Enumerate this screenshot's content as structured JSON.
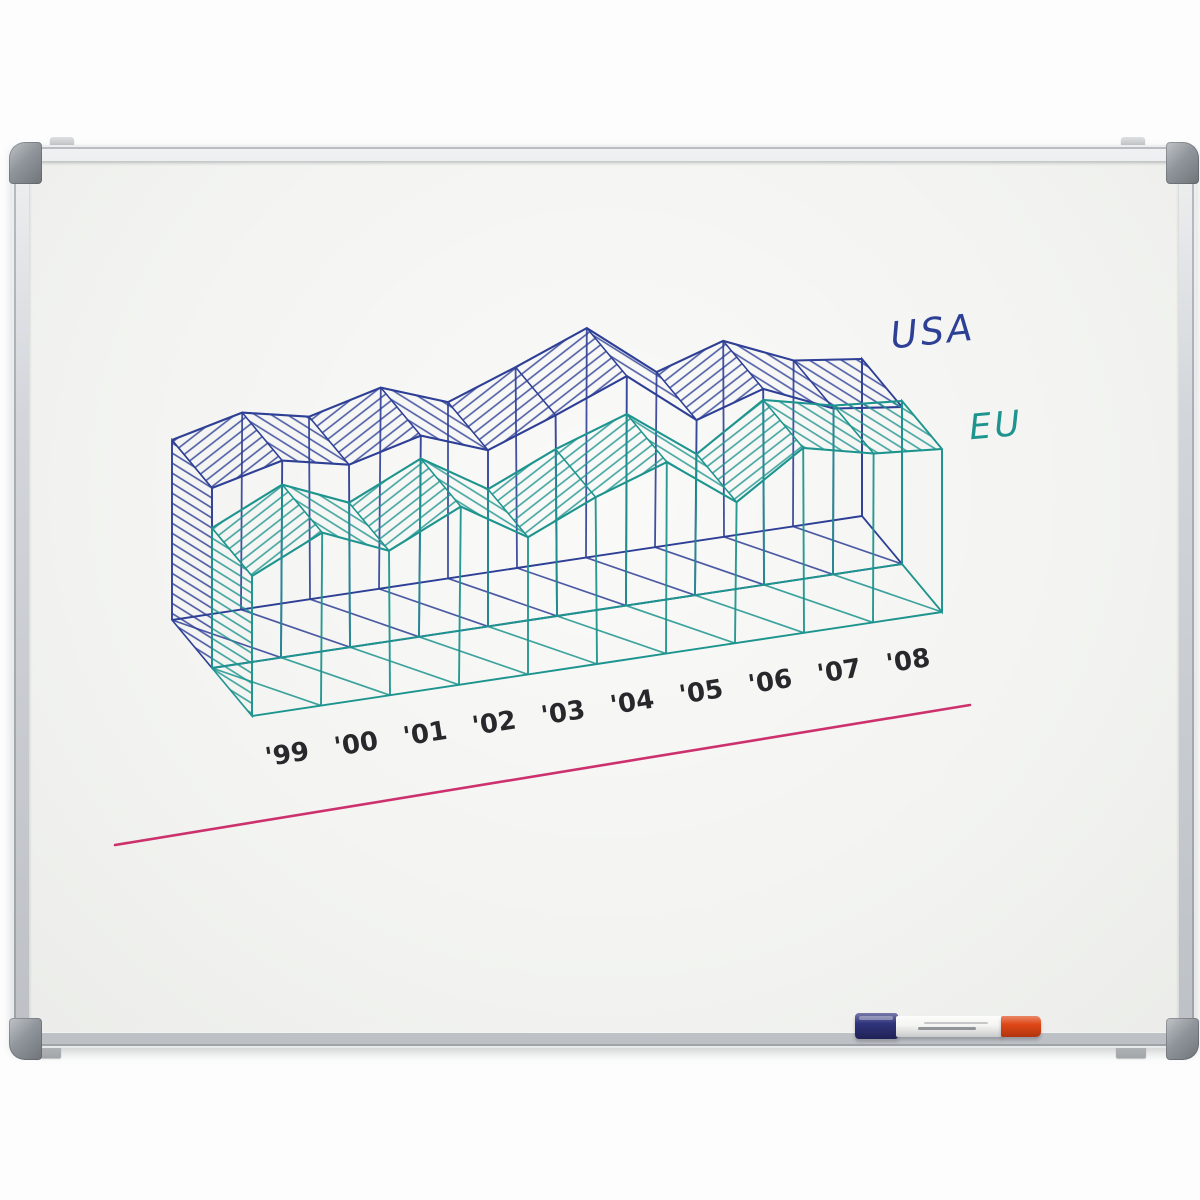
{
  "whiteboard": {
    "surface_color": "#f3f4f1",
    "frame_color": "#d2d6da",
    "corner_cap_color": "#8f959b",
    "wall_clip_color": "#b6babe"
  },
  "tray_markers": {
    "blue_marker": {
      "cap_color": "#30347c",
      "body_color": "#f4f4f2"
    },
    "red_marker": {
      "cap_color": "#df4716"
    }
  },
  "chart_data": {
    "type": "area",
    "style": "hand-drawn 3D wireframe ribbon chart on whiteboard, hatched ribbon tops, pen sketch",
    "categories": [
      "'99",
      "'00",
      "'01",
      "'02",
      "'03",
      "'04",
      "'05",
      "'06",
      "'07",
      "'08"
    ],
    "series": [
      {
        "name": "USA",
        "color": "#2e3f96",
        "profile_heights_px": [
          180,
          196,
          184,
          200,
          177,
          202,
          228,
          176,
          195,
          167,
          157
        ]
      },
      {
        "name": "EU",
        "color": "#1e948e",
        "profile_heights_px": [
          140,
          172,
          146,
          177,
          138,
          168,
          190,
          142,
          184,
          170,
          163
        ]
      }
    ],
    "baseline_color": "#cb2766",
    "tick_label_color": "#17171c",
    "legend_position": "upper right, handwritten",
    "value_axis": "none (freehand sketch, no value scale shown)"
  }
}
